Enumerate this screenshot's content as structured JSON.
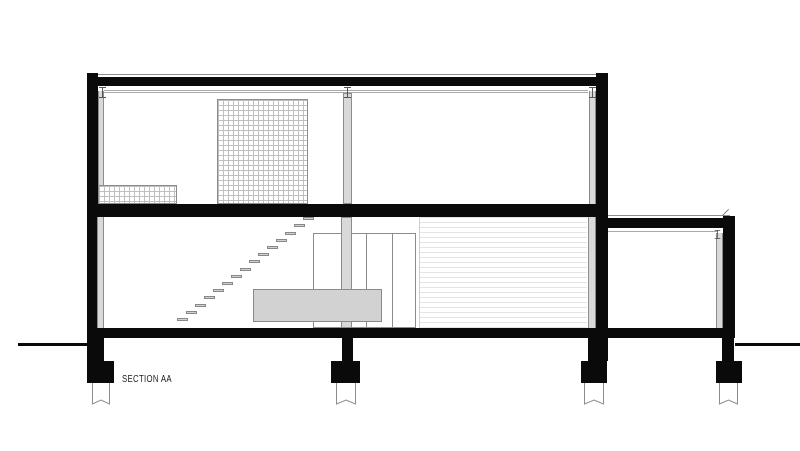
{
  "drawing": {
    "label": "SECTION AA"
  },
  "colors": {
    "ink": "#0a0a0a",
    "fill_gray": "#d9d9d9",
    "furniture_gray": "#d2d2d2",
    "grid_line": "#bfbfbf",
    "louver_line": "#e4e4e4",
    "outline": "#8c8c8c",
    "paper": "#ffffff"
  },
  "stairs": {
    "tread_count": 15,
    "start_x": 177,
    "start_y": 318,
    "step_dx": 9,
    "step_dy": -7.2,
    "tread_width": 11,
    "tread_height": 3
  },
  "foundation_levels": {
    "stem_top": 338,
    "stem_height": 23,
    "footing_top": 361,
    "footing_height": 22,
    "pile_top": 383,
    "pile_height": 26
  },
  "foundations": [
    {
      "stem": {
        "x": 87,
        "w": 17
      },
      "footing": {
        "x": 87,
        "w": 27
      },
      "pile": {
        "x": 92,
        "w": 18
      }
    },
    {
      "stem": {
        "x": 342,
        "w": 11
      },
      "footing": {
        "x": 331,
        "w": 29
      },
      "pile": {
        "x": 336,
        "w": 20
      }
    },
    {
      "stem": {
        "x": 588,
        "w": 13
      },
      "footing": {
        "x": 581,
        "w": 26
      },
      "pile": {
        "x": 584,
        "w": 20
      }
    },
    {
      "stem": {
        "x": 722,
        "w": 12
      },
      "footing": {
        "x": 716,
        "w": 26
      },
      "pile": {
        "x": 719,
        "w": 19
      }
    }
  ]
}
